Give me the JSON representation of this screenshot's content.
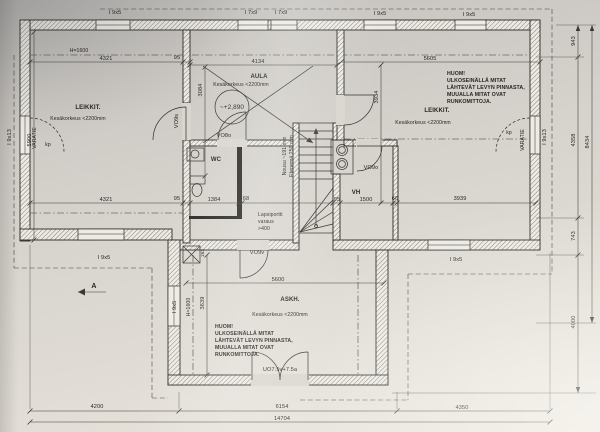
{
  "rooms": {
    "leikki_left": {
      "label": "LEIKKIT.",
      "note": "Kesäkorkeus <2200mm"
    },
    "aula": {
      "label": "AULA",
      "note": "Kesäkorkeus <2200mm",
      "level": "~+2,890"
    },
    "leikki_right": {
      "label": "LEIKKIT.",
      "note": "Kesäkorkeus <2200mm"
    },
    "askartelu": {
      "label": "ASKH.",
      "note": "Kesäkorkeus <2200mm"
    },
    "wc": {
      "label": "WC"
    },
    "vh": {
      "label": "VH"
    }
  },
  "huom": {
    "lines": [
      "HUOM!",
      "ULKOSEINÄLLÄ MITAT",
      "LÄHTEVÄT LEVYN PINNASTA,",
      "MUUALLA MITAT OVAT",
      "RUNKOMITTOJA."
    ]
  },
  "stairs": {
    "rise": "Nousu ~191 mm",
    "run": "Etenemä 250 mm",
    "gate": [
      "Lapsiportti",
      "varaus",
      ">400"
    ]
  },
  "exits": {
    "label": "VARATIE",
    "kp": "kp"
  },
  "heights": {
    "h1600": "H=1600"
  },
  "windows": {
    "top": [
      "I 9x5",
      "I 7x9",
      "I 7x9",
      "I 9x5",
      "I 9x5"
    ],
    "left": "I 9x13",
    "right": "I 9x13",
    "bottom_left": "I 9x5",
    "bottom_right": "I 9x5",
    "ext_left": "I 9x5"
  },
  "doors": {
    "vo9s": "VO9s",
    "vo8o": "VO8o",
    "vo9o": "VO9o",
    "vo9v": "VO9v",
    "uo": "UO7.5v+7.5a"
  },
  "dims": {
    "top_left": [
      "4321",
      "95"
    ],
    "top_aula": "4134",
    "top_right": "5605",
    "mid": [
      "4321",
      "95",
      "1384",
      "68",
      "95",
      "1500",
      "66",
      "3939"
    ],
    "left_v": "5900",
    "aula_v": "3084",
    "right_v": "3934",
    "ext_v": "3639",
    "ext_w": "5600",
    "bottom": [
      "4200",
      "6154",
      "4350"
    ],
    "total": "14704",
    "right_side": [
      "943",
      "4358",
      "743",
      "4000"
    ],
    "right_total": "8434",
    "flue": "163"
  },
  "section": "A"
}
